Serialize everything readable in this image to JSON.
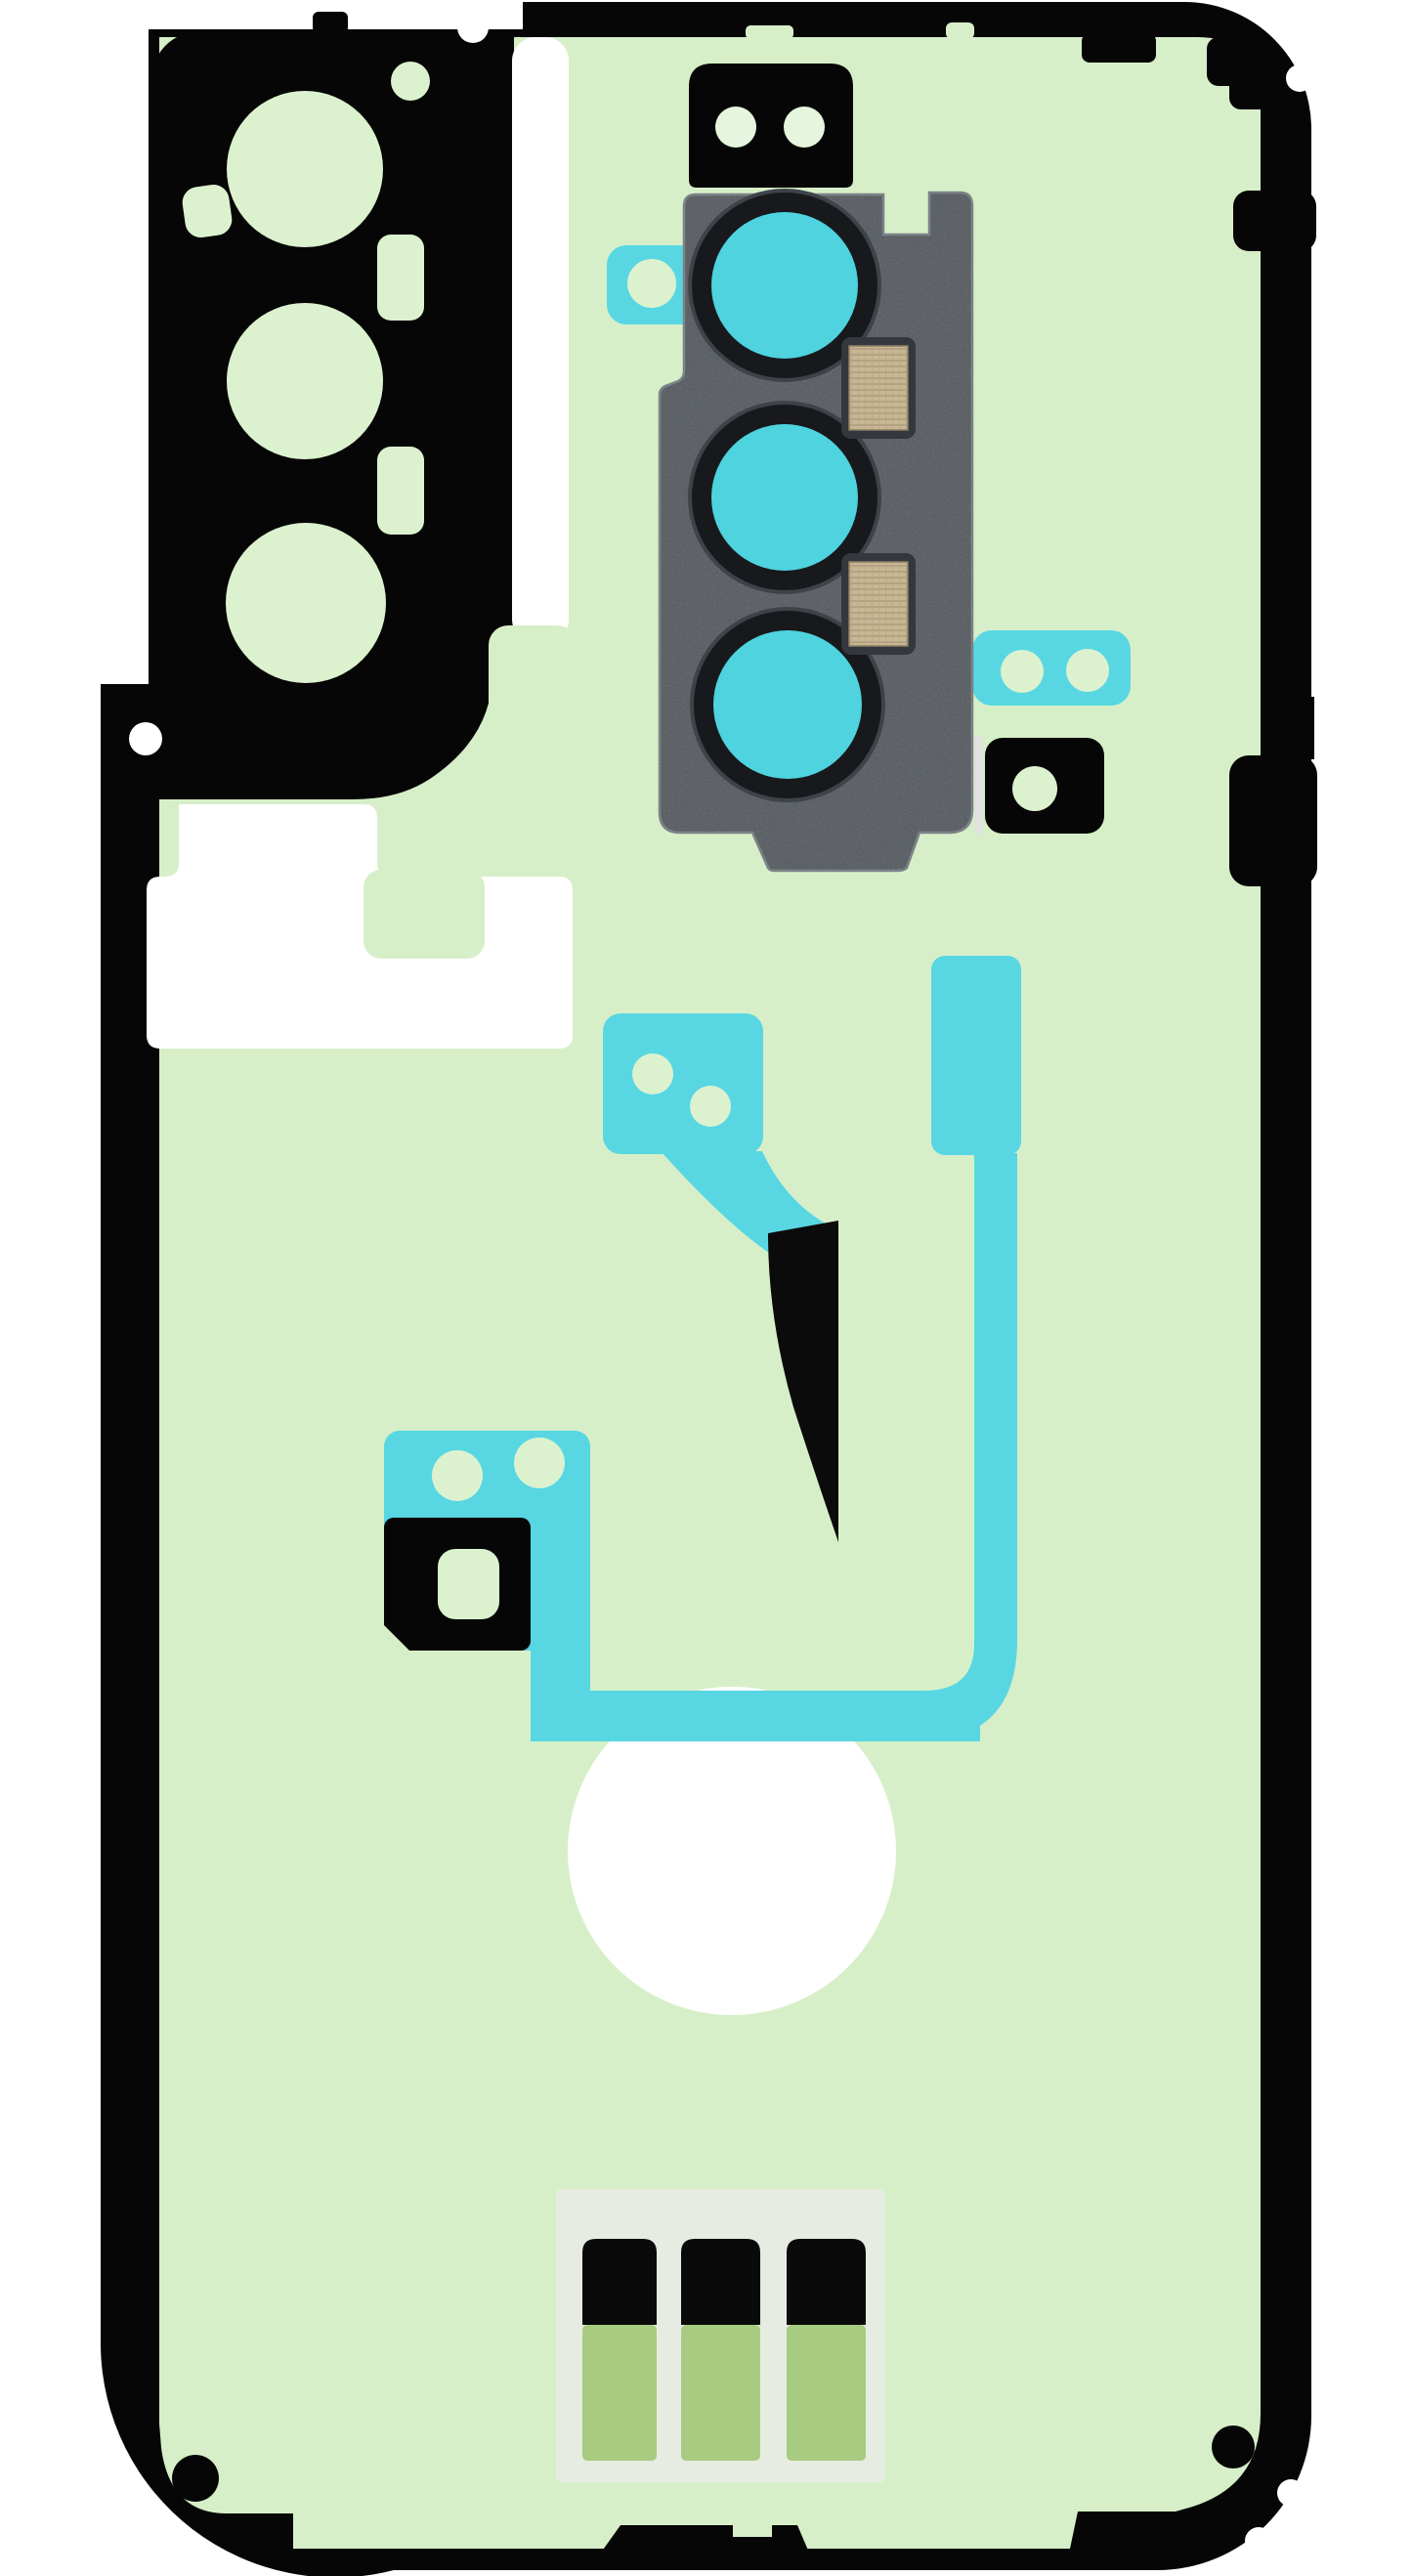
{
  "image": {
    "kind": "product-photo",
    "subject": "phone back cover adhesive sticker set with rear camera lens bezel",
    "orientation": "portrait"
  },
  "colors": {
    "background": "#ffffff",
    "outline_black": "#060606",
    "film_green": "#d7efc8",
    "hole_green": "#dcf2cf",
    "dot_green": "#e6f6de",
    "flex_cyan": "#58d7e3",
    "lens_cyan": "#4ed3df",
    "module_gray": "#565b61",
    "module_edge": "#7a8086",
    "module_highlight": "#dfe2dd",
    "ring_black": "#17191c",
    "mesh_tan": "#c8b795",
    "mesh_frame": "#34383d",
    "panel_gray": "#e7ece2",
    "strip_green": "#a7cb80",
    "strip_black": "#0a0a0a",
    "hook_black": "#0b0b0b"
  },
  "parts": {
    "main_outline": "back-cover adhesive outline",
    "camera_cutout": "camera island adhesive cutout",
    "camera_module": "rear camera lens bezel",
    "lens_count": 3,
    "mesh_contact_count": 2,
    "flex_cable_pieces": 5,
    "black_spacer_pieces": 3,
    "bottom_strip_count": 3,
    "white_cutouts": [
      "vertical slot",
      "L-shaped window",
      "large circle"
    ]
  }
}
